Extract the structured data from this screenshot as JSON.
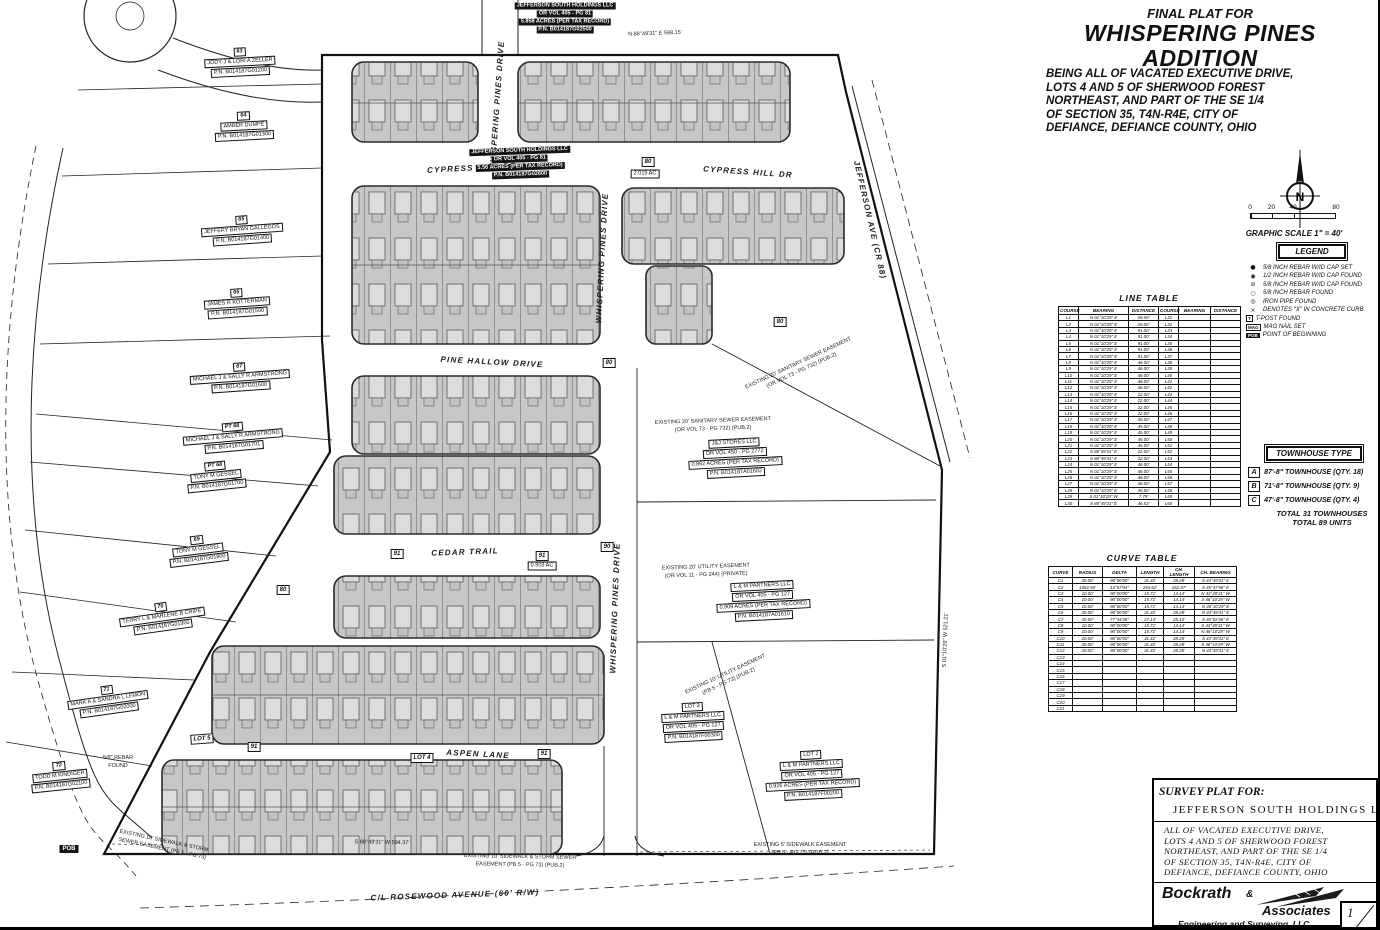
{
  "title_block": {
    "eyebrow": "FINAL PLAT FOR",
    "title_line1": "WHISPERING PINES",
    "title_line2": "ADDITION",
    "description_lines": [
      "BEING ALL OF VACATED EXECUTIVE DRIVE,",
      "LOTS 4 AND 5 OF SHERWOOD FOREST",
      "NORTHEAST, AND PART OF THE SE 1/4",
      "OF SECTION 35, T4N-R4E, CITY OF",
      "DEFIANCE, DEFIANCE COUNTY, OHIO"
    ]
  },
  "compass": {
    "label": "N"
  },
  "scale": {
    "ticks": [
      "0",
      "20",
      "40",
      "80"
    ],
    "caption": "GRAPHIC SCALE 1\" = 40'"
  },
  "legend": {
    "title": "LEGEND",
    "items": [
      {
        "sym": "●",
        "style": "glyph",
        "icon": "rebar-set-icon",
        "label": "5/8 INCH REBAR W/ID CAP SET"
      },
      {
        "sym": "◉",
        "style": "glyph",
        "icon": "rebar-cap-found-icon",
        "label": "1/2 INCH REBAR W/ID CAP FOUND"
      },
      {
        "sym": "⊘",
        "style": "glyph",
        "icon": "rebar-cap-found2-icon",
        "label": "5/8 INCH REBAR W/ID CAP FOUND"
      },
      {
        "sym": "○",
        "style": "glyph",
        "icon": "rebar-found-icon",
        "label": "5/8 INCH REBAR FOUND"
      },
      {
        "sym": "◎",
        "style": "glyph",
        "icon": "iron-pipe-icon",
        "label": "IRON PIPE FOUND"
      },
      {
        "sym": "×",
        "style": "glyph",
        "icon": "concrete-x-icon",
        "label": "DENOTES \"X\" IN CONCRETE CURB"
      },
      {
        "sym": "T",
        "style": "box",
        "icon": "t-post-icon",
        "label": "T-POST FOUND"
      },
      {
        "sym": "MAG",
        "style": "box",
        "icon": "mag-nail-icon",
        "label": "MAG NAIL SET"
      },
      {
        "sym": "POB",
        "style": "darkbox",
        "icon": "pob-icon",
        "label": "POINT OF BEGINNING"
      }
    ]
  },
  "line_table": {
    "title": "LINE TABLE",
    "headers": [
      "COURSE",
      "BEARING",
      "DISTANCE",
      "COURSE",
      "BEARING",
      "DISTANCE"
    ],
    "rows": [
      [
        "L1",
        "N 01°10'29\" E",
        "26.00'",
        "L31",
        "",
        ""
      ],
      [
        "L2",
        "N 01°10'29\" E",
        "26.00'",
        "L32",
        "",
        ""
      ],
      [
        "L3",
        "N 01°10'29\" E",
        "91.00'",
        "L33",
        "",
        ""
      ],
      [
        "L4",
        "N 01°10'29\" E",
        "91.00'",
        "L34",
        "",
        ""
      ],
      [
        "L5",
        "N 01°10'29\" E",
        "91.00'",
        "L35",
        "",
        ""
      ],
      [
        "L6",
        "N 01°10'29\" E",
        "91.00'",
        "L36",
        "",
        ""
      ],
      [
        "L7",
        "N 01°10'29\" E",
        "91.00'",
        "L37",
        "",
        ""
      ],
      [
        "L8",
        "N 01°10'29\" E",
        "46.00'",
        "L38",
        "",
        ""
      ],
      [
        "L9",
        "N 01°10'29\" E",
        "46.00'",
        "L39",
        "",
        ""
      ],
      [
        "L10",
        "N 01°10'29\" E",
        "46.00'",
        "L40",
        "",
        ""
      ],
      [
        "L11",
        "N 01°10'29\" E",
        "46.00'",
        "L41",
        "",
        ""
      ],
      [
        "L12",
        "N 01°10'29\" E",
        "46.00'",
        "L42",
        "",
        ""
      ],
      [
        "L13",
        "N 01°10'29\" E",
        "22.00'",
        "L43",
        "",
        ""
      ],
      [
        "L14",
        "N 01°10'29\" E",
        "22.00'",
        "L44",
        "",
        ""
      ],
      [
        "L15",
        "N 01°10'29\" E",
        "22.00'",
        "L45",
        "",
        ""
      ],
      [
        "L16",
        "N 01°10'29\" E",
        "22.00'",
        "L46",
        "",
        ""
      ],
      [
        "L17",
        "N 01°10'29\" E",
        "45.00'",
        "L47",
        "",
        ""
      ],
      [
        "L18",
        "N 01°10'29\" E",
        "45.00'",
        "L48",
        "",
        ""
      ],
      [
        "L19",
        "N 01°10'29\" E",
        "45.00'",
        "L49",
        "",
        ""
      ],
      [
        "L20",
        "N 01°10'29\" E",
        "45.00'",
        "L50",
        "",
        ""
      ],
      [
        "L21",
        "N 01°10'29\" E",
        "45.00'",
        "L51",
        "",
        ""
      ],
      [
        "L22",
        "S 88°49'31\" E",
        "22.00'",
        "L52",
        "",
        ""
      ],
      [
        "L23",
        "S 88°49'31\" E",
        "22.00'",
        "L53",
        "",
        ""
      ],
      [
        "L24",
        "N 01°10'29\" E",
        "46.00'",
        "L54",
        "",
        ""
      ],
      [
        "L25",
        "N 01°10'29\" E",
        "46.00'",
        "L55",
        "",
        ""
      ],
      [
        "L26",
        "N 01°10'29\" E",
        "46.00'",
        "L56",
        "",
        ""
      ],
      [
        "L27",
        "N 01°10'29\" E",
        "46.00'",
        "L57",
        "",
        ""
      ],
      [
        "L28",
        "N 01°10'29\" E",
        "45.00'",
        "L58",
        "",
        ""
      ],
      [
        "L29",
        "S 01°10'29\" W",
        "7.79'",
        "L59",
        "",
        ""
      ],
      [
        "L30",
        "S 88°49'31\" E",
        "46.53'",
        "L60",
        "",
        ""
      ]
    ]
  },
  "townhouse": {
    "title": "TOWNHOUSE TYPE",
    "rows": [
      {
        "key": "A",
        "label": "87'-8\" TOWNHOUSE (QTY. 18)"
      },
      {
        "key": "B",
        "label": "71'-8\" TOWNHOUSE (QTY. 9)"
      },
      {
        "key": "C",
        "label": "47'-8\" TOWNHOUSE (QTY. 4)"
      }
    ],
    "totals": [
      "TOTAL 31 TOWNHOUSES",
      "TOTAL 89 UNITS"
    ]
  },
  "curve_table": {
    "title": "CURVE TABLE",
    "headers": [
      "CURVE",
      "RADIUS",
      "DELTA",
      "LENGTH",
      "CH. LENGTH",
      "CH. BEARING"
    ],
    "rows": [
      [
        "C1",
        "20.00'",
        "90°00'00\"",
        "31.42'",
        "28.28'",
        "S 43°49'31\" E"
      ],
      [
        "C2",
        "1082.50'",
        "13°57'04\"",
        "263.62'",
        "262.97'",
        "S 45°47'58\" E"
      ],
      [
        "C3",
        "10.00'",
        "90°00'00\"",
        "15.71'",
        "14.14'",
        "N 43°49'31\" W"
      ],
      [
        "C4",
        "10.00'",
        "90°00'00\"",
        "15.71'",
        "14.14'",
        "S 46°10'29\" W"
      ],
      [
        "C5",
        "10.00'",
        "90°00'00\"",
        "15.71'",
        "14.14'",
        "N 46°10'29\" E"
      ],
      [
        "C6",
        "20.00'",
        "90°00'00\"",
        "31.42'",
        "28.28'",
        "N 43°49'31\" E"
      ],
      [
        "C7",
        "20.00'",
        "77°44'28\"",
        "27.14'",
        "25.10'",
        "S 40°02'45\" E"
      ],
      [
        "C8",
        "10.00'",
        "90°00'00\"",
        "15.71'",
        "14.14'",
        "S 43°49'31\" W"
      ],
      [
        "C9",
        "10.00'",
        "90°00'00\"",
        "15.71'",
        "14.14'",
        "N 46°10'29\" W"
      ],
      [
        "C10",
        "20.00'",
        "90°00'00\"",
        "31.42'",
        "28.28'",
        "S 43°49'31\" E"
      ],
      [
        "C11",
        "20.00'",
        "90°00'00\"",
        "31.42'",
        "28.28'",
        "S 46°10'29\" W"
      ],
      [
        "C12",
        "20.00'",
        "90°00'00\"",
        "31.42'",
        "28.28'",
        "N 43°49'31\" E"
      ],
      [
        "C13",
        "",
        "",
        "",
        "",
        ""
      ],
      [
        "C14",
        "",
        "",
        "",
        "",
        ""
      ],
      [
        "C15",
        "",
        "",
        "",
        "",
        ""
      ],
      [
        "C16",
        "",
        "",
        "",
        "",
        ""
      ],
      [
        "C17",
        "",
        "",
        "",
        "",
        ""
      ],
      [
        "C18",
        "",
        "",
        "",
        "",
        ""
      ],
      [
        "C19",
        "",
        "",
        "",
        "",
        ""
      ],
      [
        "C20",
        "",
        "",
        "",
        "",
        ""
      ],
      [
        "C21",
        "",
        "",
        "",
        "",
        ""
      ]
    ]
  },
  "survey_block": {
    "label": "SURVEY PLAT FOR:",
    "client": "JEFFERSON SOUTH HOLDINGS LLC",
    "description_lines": [
      "ALL OF VACATED EXECUTIVE DRIVE,",
      "LOTS 4 AND 5 OF SHERWOOD FOREST",
      "NORTHEAST, AND PART OF THE SE 1/4",
      "OF SECTION 35, T4N-R4E, CITY OF",
      "DEFIANCE, DEFIANCE COUNTY, OHIO"
    ],
    "firm_name_1": "Bockrath",
    "firm_amp": "&",
    "firm_name_2": "Associates",
    "firm_line": "Engineering and Surveying, LLC",
    "firm_address": "115 S. Fair Avenue, Suite A - Ottawa - Ohio",
    "firm_phone": "Phone: 419.523.5789",
    "sheet_top": "1",
    "sheet_bottom": "2"
  },
  "plat": {
    "streets": [
      {
        "label": "CYPRESS HILL DR",
        "x": 472,
        "y": 168,
        "rot": -3
      },
      {
        "label": "CYPRESS HILL DR",
        "x": 748,
        "y": 172,
        "rot": 4
      },
      {
        "label": "PINE HALLOW DRIVE",
        "x": 492,
        "y": 362,
        "rot": 3
      },
      {
        "label": "CEDAR TRAIL",
        "x": 465,
        "y": 552,
        "rot": -2
      },
      {
        "label": "ASPEN LANE",
        "x": 478,
        "y": 754,
        "rot": 3
      },
      {
        "label": "WHISPERING PINES DRIVE",
        "x": 497,
        "y": 106,
        "rot": -86
      },
      {
        "label": "WHISPERING PINES DRIVE",
        "x": 602,
        "y": 258,
        "rot": -87
      },
      {
        "label": "WHISPERING PINES DRIVE",
        "x": 615,
        "y": 608,
        "rot": -88
      },
      {
        "label": "JEFFERSON AVE (CR 88)",
        "x": 870,
        "y": 220,
        "rot": 77
      },
      {
        "label": "C/L ROSEWOOD AVENUE (60' R/W)",
        "x": 455,
        "y": 895,
        "rot": -2
      }
    ],
    "parcels": [
      {
        "num": "63",
        "owner": "JODY J & LORI A ZELLER",
        "pn": "P.N. B014187G01200",
        "x": 240,
        "y": 62,
        "rot": -3
      },
      {
        "num": "64",
        "owner": "AMBER DUMPE",
        "pn": "P.N. B014187G01300",
        "x": 244,
        "y": 126,
        "rot": -3
      },
      {
        "num": "65",
        "owner": "JEFFERY BRYAN GALLEGOS",
        "pn": "P.N. B014187G01400",
        "x": 242,
        "y": 230,
        "rot": -4
      },
      {
        "num": "66",
        "owner": "JAMES R KOTTERMAN",
        "pn": "P.N. B014187G01500",
        "x": 237,
        "y": 303,
        "rot": -4
      },
      {
        "num": "67",
        "owner": "MICHAEL J & SALLY R ARMSTRONG",
        "pn": "P.N. B014187G01600",
        "x": 240,
        "y": 377,
        "rot": -4
      },
      {
        "num": "PT 68",
        "owner": "MICHAEL J & SALLY R ARMSTRONG",
        "pn": "P.N. B014187G01701",
        "x": 233,
        "y": 437,
        "rot": -5
      },
      {
        "num": "PT 68",
        "owner": "TONY M GESSEL",
        "pn": "P.N. B014187G01700",
        "x": 216,
        "y": 476,
        "rot": -6
      },
      {
        "num": "69",
        "owner": "TONY M GESSEL",
        "pn": "P.N. B014187G01800",
        "x": 198,
        "y": 550,
        "rot": -7
      },
      {
        "num": "70",
        "owner": "TERRY L & MARLENE B CRIPE",
        "pn": "P.N. B014187G01900",
        "x": 162,
        "y": 617,
        "rot": -8
      },
      {
        "num": "71",
        "owner": "MARK A & SANDRA L LEMON",
        "pn": "P.N. B014187G02000",
        "x": 108,
        "y": 700,
        "rot": -8
      },
      {
        "num": "72",
        "owner": "TODD M KINDIGER",
        "pn": "P.N. B014187G02100",
        "x": 60,
        "y": 776,
        "rot": -6
      }
    ],
    "annotations": [
      {
        "style": "dark",
        "x": 565,
        "y": 18,
        "rot": 0,
        "lines": [
          "JEFFERSON SOUTH HOLDINGS LLC",
          "OR VOL 405 - PG 81",
          "5.858 ACRES (PER TAX RECORD)",
          "P.N. B014187G02500"
        ]
      },
      {
        "style": "dark",
        "x": 520,
        "y": 163,
        "rot": -2,
        "lines": [
          "JEFFERSON SOUTH HOLDINGS LLC",
          "OR VOL 405 - PG 81",
          "5.56 ACRES (PER TAX RECORD)",
          "P.N. B014187G02600"
        ]
      },
      {
        "style": "tag",
        "x": 648,
        "y": 162,
        "rot": 0,
        "lines": [
          "80"
        ]
      },
      {
        "style": "boxed",
        "x": 645,
        "y": 174,
        "rot": 0,
        "lines": [
          "2.019 AC"
        ]
      },
      {
        "style": "tag",
        "x": 609,
        "y": 363,
        "rot": 0,
        "lines": [
          "80"
        ]
      },
      {
        "style": "tag",
        "x": 780,
        "y": 322,
        "rot": 0,
        "lines": [
          "80"
        ]
      },
      {
        "style": "tag",
        "x": 283,
        "y": 590,
        "rot": 0,
        "lines": [
          "80"
        ]
      },
      {
        "style": "tag",
        "x": 607,
        "y": 547,
        "rot": 0,
        "lines": [
          "90"
        ]
      },
      {
        "style": "tag",
        "x": 397,
        "y": 554,
        "rot": 0,
        "lines": [
          "91"
        ]
      },
      {
        "style": "tag",
        "x": 542,
        "y": 556,
        "rot": 0,
        "lines": [
          "91"
        ]
      },
      {
        "style": "boxed",
        "x": 542,
        "y": 566,
        "rot": 0,
        "lines": [
          "0.903 AC"
        ]
      },
      {
        "style": "tag",
        "x": 254,
        "y": 747,
        "rot": 0,
        "lines": [
          "91"
        ]
      },
      {
        "style": "tag",
        "x": 544,
        "y": 754,
        "rot": 0,
        "lines": [
          "91"
        ]
      },
      {
        "style": "tag",
        "x": 202,
        "y": 739,
        "rot": -4,
        "lines": [
          "LOT 5"
        ]
      },
      {
        "style": "tag",
        "x": 422,
        "y": 758,
        "rot": 0,
        "lines": [
          "LOT 4"
        ]
      },
      {
        "style": "boxed",
        "x": 735,
        "y": 458,
        "rot": -3,
        "lines": [
          "J&J STORES LLC",
          "OR VOL 450 - PG 2772",
          "0.862 ACRES (PER TAX RECORD)",
          "P.N. B014187A01602"
        ]
      },
      {
        "style": "boxed",
        "x": 763,
        "y": 601,
        "rot": -3,
        "lines": [
          "L & M PARTNERS LLC",
          "OR VOL 405 - PG 127",
          "0.909 ACRES (PER TAX RECORD)",
          "P.N. B014187A01610"
        ]
      },
      {
        "style": "boxed",
        "x": 693,
        "y": 722,
        "rot": -3,
        "lines": [
          "LOT 3",
          "L & M PARTNERS LLC",
          "OR VOL 405 - PG 127",
          "P.N. B014187F00300"
        ]
      },
      {
        "style": "boxed",
        "x": 812,
        "y": 775,
        "rot": -3,
        "lines": [
          "LOT 2",
          "L & M PARTNERS LLC",
          "OR VOL 405 - PG 127",
          "0.926 ACRES (PER TAX RECORD)",
          "P.N. B014187F00200"
        ]
      },
      {
        "style": "plain",
        "x": 713,
        "y": 425,
        "rot": -2,
        "lines": [
          "EXISTING 20' SANITARY SEWER EASEMENT",
          "(OR VOL 73 - PG 732) (PUB.2)"
        ]
      },
      {
        "style": "plain",
        "x": 800,
        "y": 367,
        "rot": -25,
        "lines": [
          "EXISTING 20' SANITARY SEWER EASEMENT",
          "(OR VOL 73 - PG 732) (PUB.2)"
        ]
      },
      {
        "style": "plain",
        "x": 706,
        "y": 571,
        "rot": -2,
        "lines": [
          "EXISTING 20' UTILITY EASEMENT",
          "(OR VOL 11 - PG 244) (PRIVATE)"
        ]
      },
      {
        "style": "plain",
        "x": 727,
        "y": 678,
        "rot": -25,
        "lines": [
          "EXISTING 10' UTILITY EASEMENT",
          "(PB 5 - PG 73) (PUB.2)"
        ]
      },
      {
        "style": "plain",
        "x": 520,
        "y": 861,
        "rot": 1,
        "lines": [
          "EXISTING 10' SIDEWALK & STORM SEWER",
          "EASEMENT (PB 5 - PG 73) (PUB.2)"
        ]
      },
      {
        "style": "plain",
        "x": 163,
        "y": 845,
        "rot": 12,
        "lines": [
          "EXISTING 10' SIDEWALK & STORM",
          "SEWER EASEMENT (PB 5 - PG 73)"
        ]
      },
      {
        "style": "plain",
        "x": 800,
        "y": 849,
        "rot": 0,
        "lines": [
          "EXISTING 5' SIDEWALK EASEMENT",
          "(PB 5 - PG 73) (PUB.2)"
        ]
      },
      {
        "style": "plain",
        "x": 118,
        "y": 762,
        "rot": 0,
        "lines": [
          "5/8\" REBAR",
          "FOUND"
        ]
      },
      {
        "style": "tagdark",
        "x": 69,
        "y": 849,
        "rot": 0,
        "lines": [
          "POB"
        ]
      },
      {
        "style": "plain",
        "x": 655,
        "y": 34,
        "rot": -2,
        "lines": [
          "N 88°49'31\" E  598.15'"
        ]
      },
      {
        "style": "plain",
        "x": 382,
        "y": 843,
        "rot": 1,
        "lines": [
          "S 88°49'31\" W  594.37'"
        ]
      },
      {
        "style": "plain",
        "x": 946,
        "y": 640,
        "rot": -88,
        "lines": [
          "S 01°10'29\" W  521.21'"
        ]
      }
    ]
  },
  "colors": {
    "ink": "#1a1a1a",
    "block_fill": "#c7c7c7",
    "unit_fill": "#dcdcdc",
    "paper": "#ffffff"
  }
}
